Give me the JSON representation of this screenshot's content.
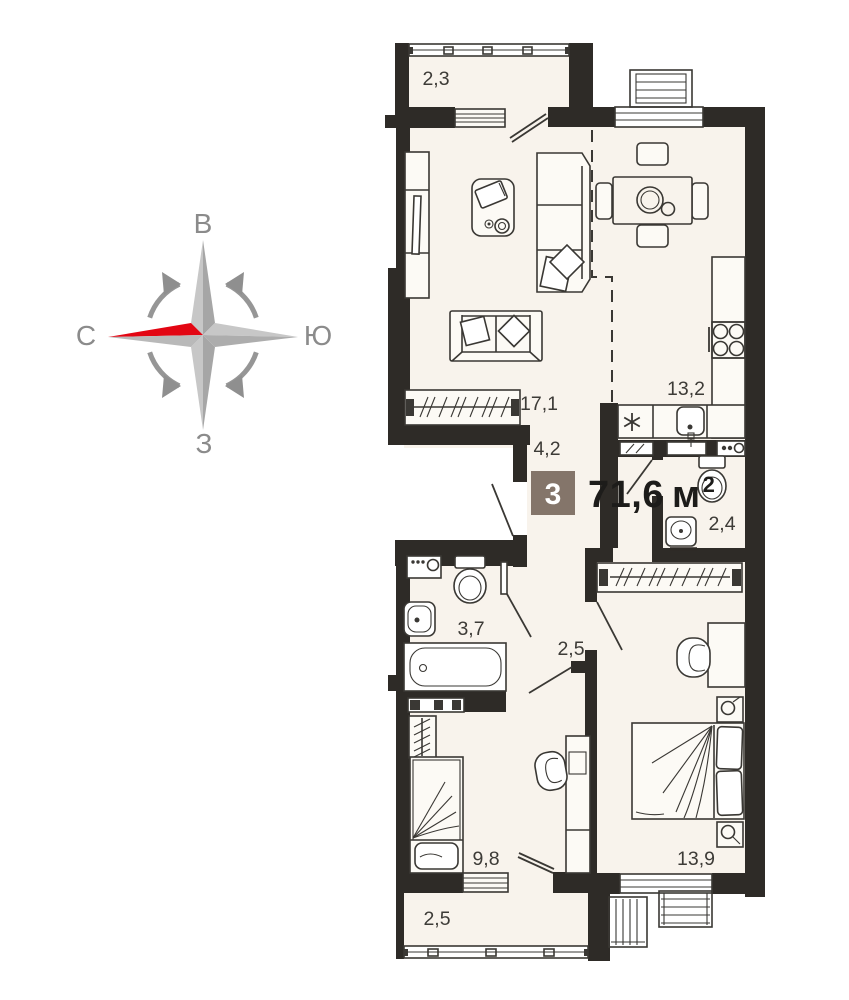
{
  "plan": {
    "badge": "3",
    "total_area": {
      "value": "71,6",
      "unit": "м",
      "power": "2"
    }
  },
  "compass": {
    "top": "В",
    "right": "Ю",
    "bottom": "З",
    "left": "С"
  },
  "rooms": [
    {
      "id": "balcony-top",
      "label": "2,3"
    },
    {
      "id": "living-room",
      "label": "17,1"
    },
    {
      "id": "kitchen",
      "label": "13,2"
    },
    {
      "id": "hallway",
      "label": "4,2"
    },
    {
      "id": "wc",
      "label": "2,4"
    },
    {
      "id": "bathroom",
      "label": "3,7"
    },
    {
      "id": "hallway-2",
      "label": "2,5"
    },
    {
      "id": "room",
      "label": "9,8"
    },
    {
      "id": "bedroom",
      "label": "13,9"
    },
    {
      "id": "balcony-bottom",
      "label": "2,5"
    }
  ],
  "colors": {
    "wall": "#2e2b27",
    "floor": "#f8f3ec",
    "line": "#3a3834",
    "badge": "#84756a",
    "compass_red": "#e30613",
    "compass_gray": "#8b8b8b"
  }
}
